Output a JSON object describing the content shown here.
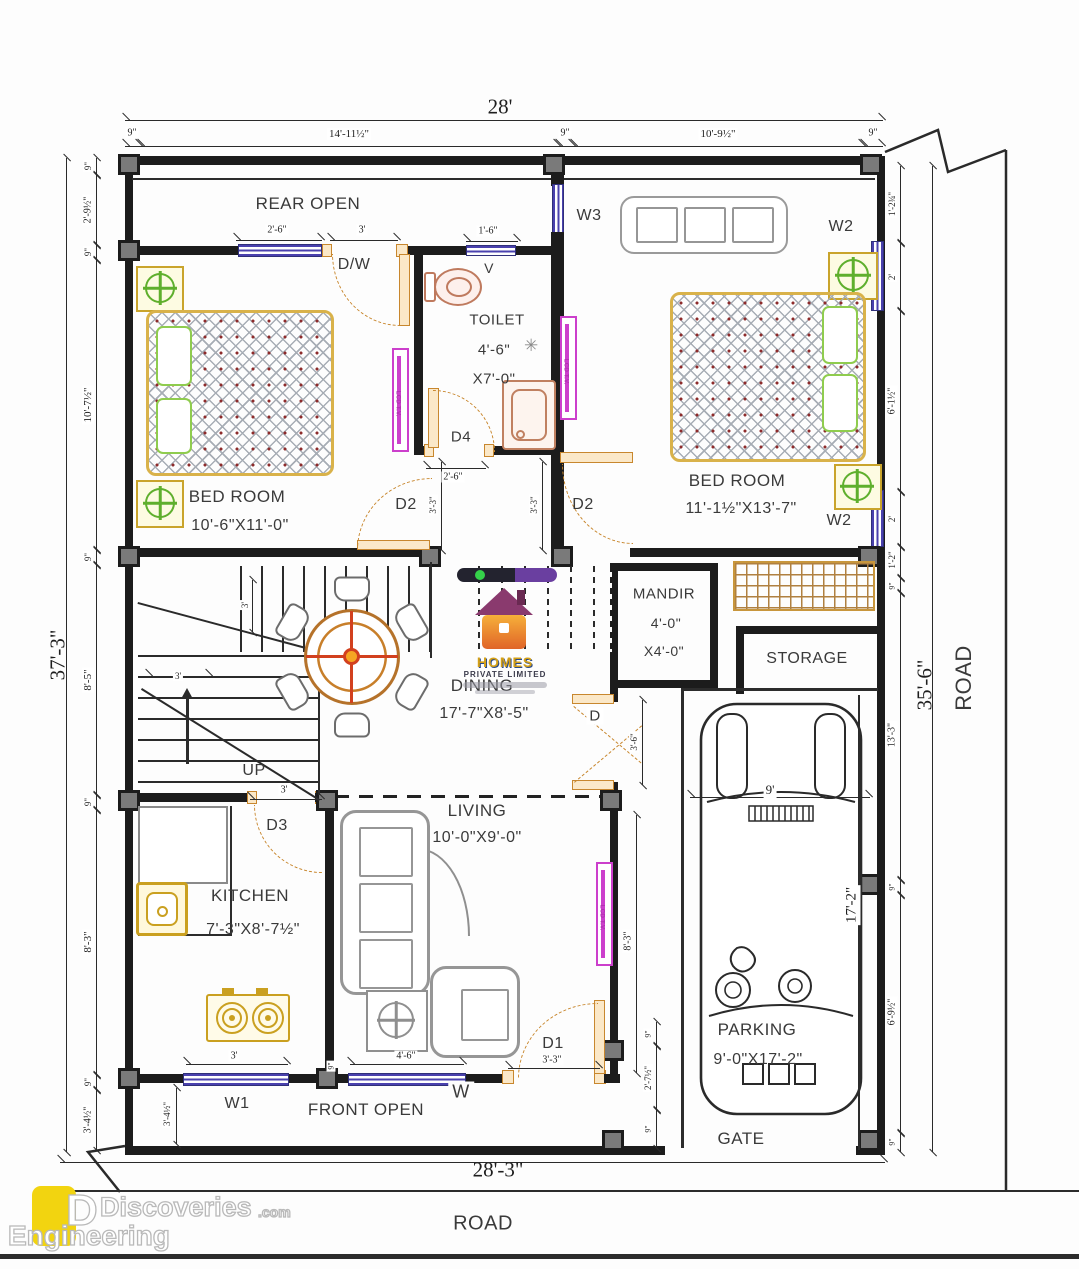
{
  "labels": {
    "rear_open": "REAR OPEN",
    "front_open": "FRONT OPEN",
    "gate": "GATE",
    "road_bottom": "ROAD",
    "road_right": "ROAD",
    "up": "UP",
    "vent": "V"
  },
  "rooms": {
    "bedroom1": {
      "name": "BED ROOM",
      "size": "10'-6\"X11'-0\""
    },
    "bedroom2": {
      "name": "BED ROOM",
      "size": "11'-1½\"X13'-7\""
    },
    "toilet": {
      "name": "TOILET",
      "w": "4'-6\"",
      "l": "X7'-0\""
    },
    "mandir": {
      "name": "MANDIR",
      "w": "4'-0\"",
      "l": "X4'-0\""
    },
    "dining": {
      "name": "DINING",
      "size": "17'-7\"X8'-5\""
    },
    "living": {
      "name": "LIVING",
      "size": "10'-0\"X9'-0\""
    },
    "kitchen": {
      "name": "KITCHEN",
      "size": "7'-3\"X8'-7½\""
    },
    "storage": {
      "name": "STORAGE"
    },
    "parking": {
      "name": "PARKING",
      "size": "9'-0\"X17'-2\""
    }
  },
  "openings": {
    "dw": "D/W",
    "d": "D",
    "d1": "D1",
    "d2": "D2",
    "d3": "D3",
    "d4": "D4",
    "w": "W",
    "w1": "W1",
    "w2": "W2",
    "w3": "W3"
  },
  "furniture": {
    "tv": "LCD T.V."
  },
  "dims": {
    "top_overall": "28'",
    "top": [
      "9\"",
      "14'-11½\"",
      "9\"",
      "10'-9½\"",
      "9\""
    ],
    "left_overall": "37'-3\"",
    "left": [
      "9\"",
      "2'-9½\"",
      "9\"",
      "10'-7½\"",
      "9\"",
      "8'-5\"",
      "9\"",
      "8'-3\"",
      "9\"",
      "3'-4½\""
    ],
    "right_overall": "35'-6\"",
    "right": [
      "1'-2¾\"",
      "2'",
      "6'-1½\"",
      "2'",
      "1'-2\"",
      "9\"",
      "13'-3\"",
      "9\"",
      "6'-9½\"",
      "9\""
    ],
    "bottom_overall": "28'-3\"",
    "inner": {
      "rear_win": "2'-6\"",
      "dw": "3'",
      "vent": "1'-6\"",
      "d4": "2'-6\"",
      "d2a": "3'-3\"",
      "d2b": "3'-3\"",
      "stair_u": "3'",
      "stair_l": "3'",
      "mandir_door": "3'-6\"",
      "park_w": "9'",
      "park_l": "17'-2\"",
      "living_h": "8'-3\"",
      "d3": "3'",
      "d1": "3'-3\"",
      "win_w": "4'-6\"",
      "win_w1": "3'",
      "front_1": "3'-4½\"",
      "wall_9": "9\"",
      "gate_1": "9\"",
      "gate_2": "2'-7½\"",
      "gate_3": "9\""
    }
  },
  "watermark": {
    "line1": "HOMES",
    "line2": "PRIVATE LIMITED"
  },
  "brand": {
    "word1": "Discoveries",
    "suffix": ".com",
    "word2": "Engineering",
    "logo_e": "E",
    "logo_d": "D"
  }
}
